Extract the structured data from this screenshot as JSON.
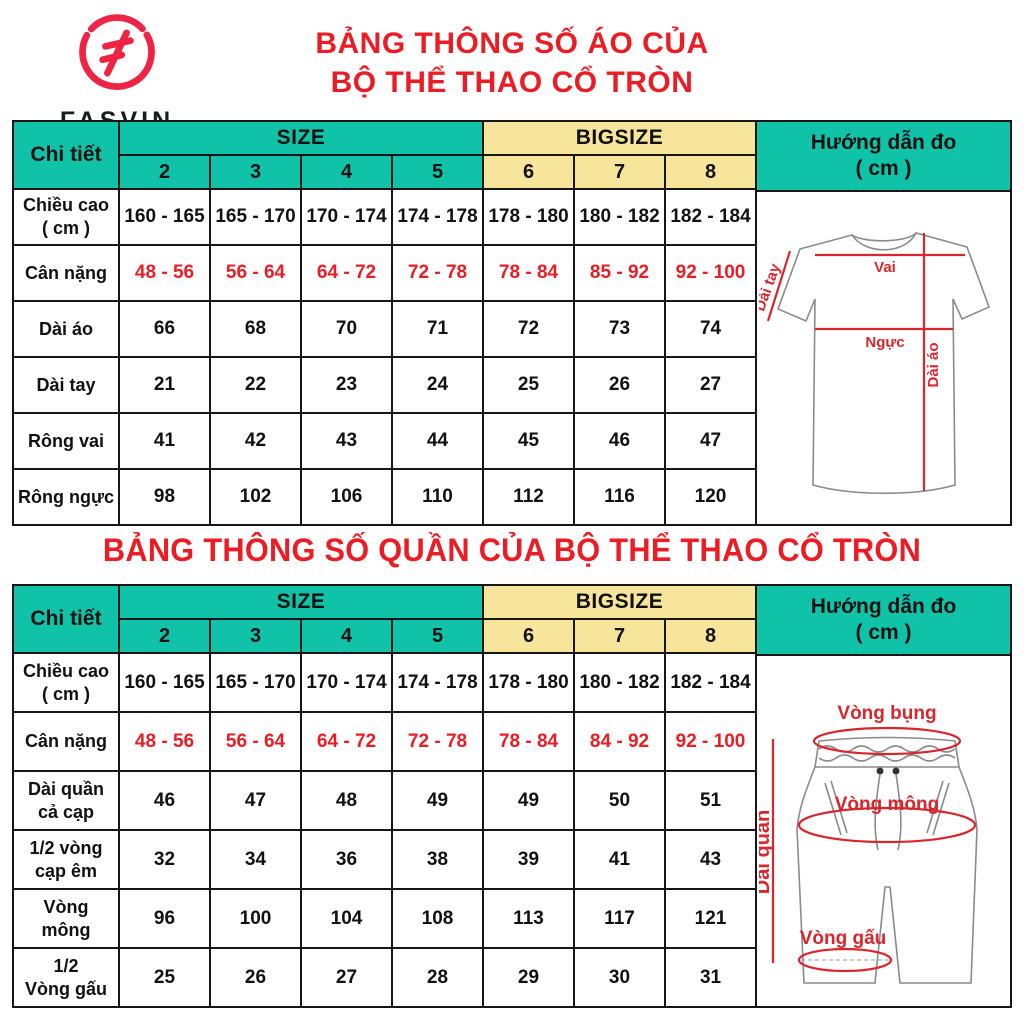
{
  "brand": {
    "name": "FASVIN",
    "tagline": "Sports fashion",
    "logo_color": "#ef2343"
  },
  "colors": {
    "teal": "#10c3a8",
    "yellow": "#f8e59c",
    "title_red": "#ec1c24",
    "diagram_red": "#d9262c",
    "border": "#161616"
  },
  "shirt_section": {
    "title_line1": "BẢNG THÔNG SỐ ÁO CỦA",
    "title_line2": "BỘ THỂ THAO CỔ TRÒN",
    "table": {
      "detail_header": "Chi tiết",
      "size_group": "SIZE",
      "bigsize_group": "BIGSIZE",
      "size_cols": [
        "2",
        "3",
        "4",
        "5"
      ],
      "bigsize_cols": [
        "6",
        "7",
        "8"
      ],
      "guide_header_line1": "Hướng dẫn đo",
      "guide_header_line2": "( cm )",
      "rows": [
        {
          "label": "Chiều cao\n( cm )",
          "red": false,
          "values": [
            "160 - 165",
            "165 - 170",
            "170 - 174",
            "174 - 178",
            "178 - 180",
            "180 - 182",
            "182 - 184"
          ]
        },
        {
          "label": "Cân nặng",
          "red": true,
          "values": [
            "48 - 56",
            "56 - 64",
            "64 - 72",
            "72 - 78",
            "78 - 84",
            "85 - 92",
            "92 - 100"
          ]
        },
        {
          "label": "Dài áo",
          "red": false,
          "values": [
            "66",
            "68",
            "70",
            "71",
            "72",
            "73",
            "74"
          ]
        },
        {
          "label": "Dài tay",
          "red": false,
          "values": [
            "21",
            "22",
            "23",
            "24",
            "25",
            "26",
            "27"
          ]
        },
        {
          "label": "Rông vai",
          "red": false,
          "values": [
            "41",
            "42",
            "43",
            "44",
            "45",
            "46",
            "47"
          ]
        },
        {
          "label": "Rông ngực",
          "red": false,
          "values": [
            "98",
            "102",
            "106",
            "110",
            "112",
            "116",
            "120"
          ]
        }
      ]
    },
    "diagram": {
      "vai": "Vai",
      "nguc": "Ngực",
      "dai_tay": "Dài tay",
      "dai_ao": "Dài áo"
    }
  },
  "pants_section": {
    "title": "BẢNG THÔNG SỐ QUẦN CỦA BỘ THỂ THAO CỔ TRÒN",
    "table": {
      "detail_header": "Chi tiết",
      "size_group": "SIZE",
      "bigsize_group": "BIGSIZE",
      "size_cols": [
        "2",
        "3",
        "4",
        "5"
      ],
      "bigsize_cols": [
        "6",
        "7",
        "8"
      ],
      "guide_header_line1": "Hướng dẫn đo",
      "guide_header_line2": "( cm )",
      "rows": [
        {
          "label": "Chiều cao\n( cm )",
          "red": false,
          "values": [
            "160 - 165",
            "165 - 170",
            "170 - 174",
            "174 - 178",
            "178 - 180",
            "180 - 182",
            "182 - 184"
          ]
        },
        {
          "label": "Cân nặng",
          "red": true,
          "values": [
            "48 - 56",
            "56 - 64",
            "64 - 72",
            "72 - 78",
            "78 - 84",
            "84 - 92",
            "92 - 100"
          ]
        },
        {
          "label": "Dài quần\ncả cạp",
          "red": false,
          "values": [
            "46",
            "47",
            "48",
            "49",
            "49",
            "50",
            "51"
          ]
        },
        {
          "label": "1/2 vòng\ncạp êm",
          "red": false,
          "values": [
            "32",
            "34",
            "36",
            "38",
            "39",
            "41",
            "43"
          ]
        },
        {
          "label": "Vòng\nmông",
          "red": false,
          "values": [
            "96",
            "100",
            "104",
            "108",
            "113",
            "117",
            "121"
          ]
        },
        {
          "label": "1/2\nVòng gấu",
          "red": false,
          "values": [
            "25",
            "26",
            "27",
            "28",
            "29",
            "30",
            "31"
          ]
        }
      ]
    },
    "diagram": {
      "vong_bung": "Vòng bụng",
      "vong_mong": "Vòng mông",
      "vong_gau": "Vòng gấu",
      "dai_quan": "Dài quần"
    }
  }
}
